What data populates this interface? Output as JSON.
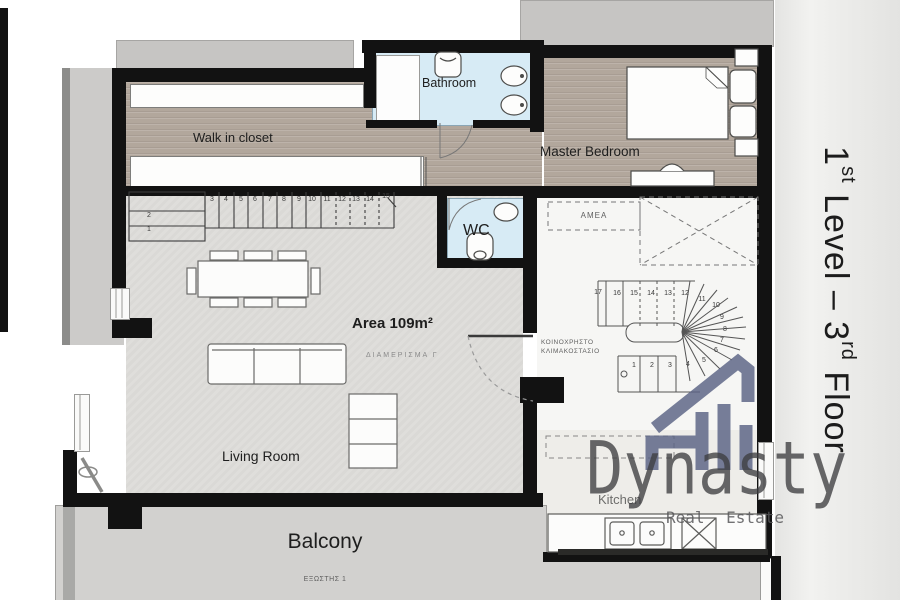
{
  "side_panel": {
    "label_parts": {
      "num": "1",
      "sup1": "st",
      "mid": " Level – 3",
      "sup2": "rd",
      "end": " Floor"
    }
  },
  "watermark": {
    "brand": "Dynasty",
    "tagline": "Real Estate"
  },
  "rooms": {
    "walk_in_closet": "Walk in closet",
    "bathroom": "Bathroom",
    "master_bedroom": "Master Bedroom",
    "wc": "WC",
    "living_room": "Living Room",
    "kitchen": "Kitchen",
    "balcony": "Balcony"
  },
  "labels": {
    "area": "Area 109m²",
    "apartment_unit": "ΔΙΑΜΕΡΙΣΜΑ Γ",
    "amea": "ΑΜΕΑ",
    "stairwell_line1": "ΚΟΙΝΟΧΡΗΣΤΟ",
    "stairwell_line2": "ΚΛΙΜΑΚΟΣΤΑΣΙΟ",
    "balcony_sub": "ΕΞΩΣΤΗΣ 1"
  },
  "stairs": {
    "interior": [
      "1",
      "2",
      "3",
      "4",
      "5",
      "6",
      "7",
      "8",
      "9",
      "10",
      "11",
      "12",
      "13",
      "14",
      "15"
    ],
    "communal": [
      "1",
      "2",
      "3",
      "4",
      "5",
      "6",
      "7",
      "8",
      "9",
      "10",
      "11",
      "12",
      "13",
      "14",
      "15",
      "16",
      "17"
    ]
  },
  "colors": {
    "wall": "#121212",
    "wood_floor": "#b2a79c",
    "bathroom_blue": "#d7ebf5",
    "living_gray": "#dddcd9",
    "balcony_gray": "#d2d1cf",
    "terrace_gray": "#cccbc9",
    "side_panel_gray": "#ececea",
    "watermark_slate": "#5a6384",
    "watermark_text_gray": "#3e3e40"
  }
}
